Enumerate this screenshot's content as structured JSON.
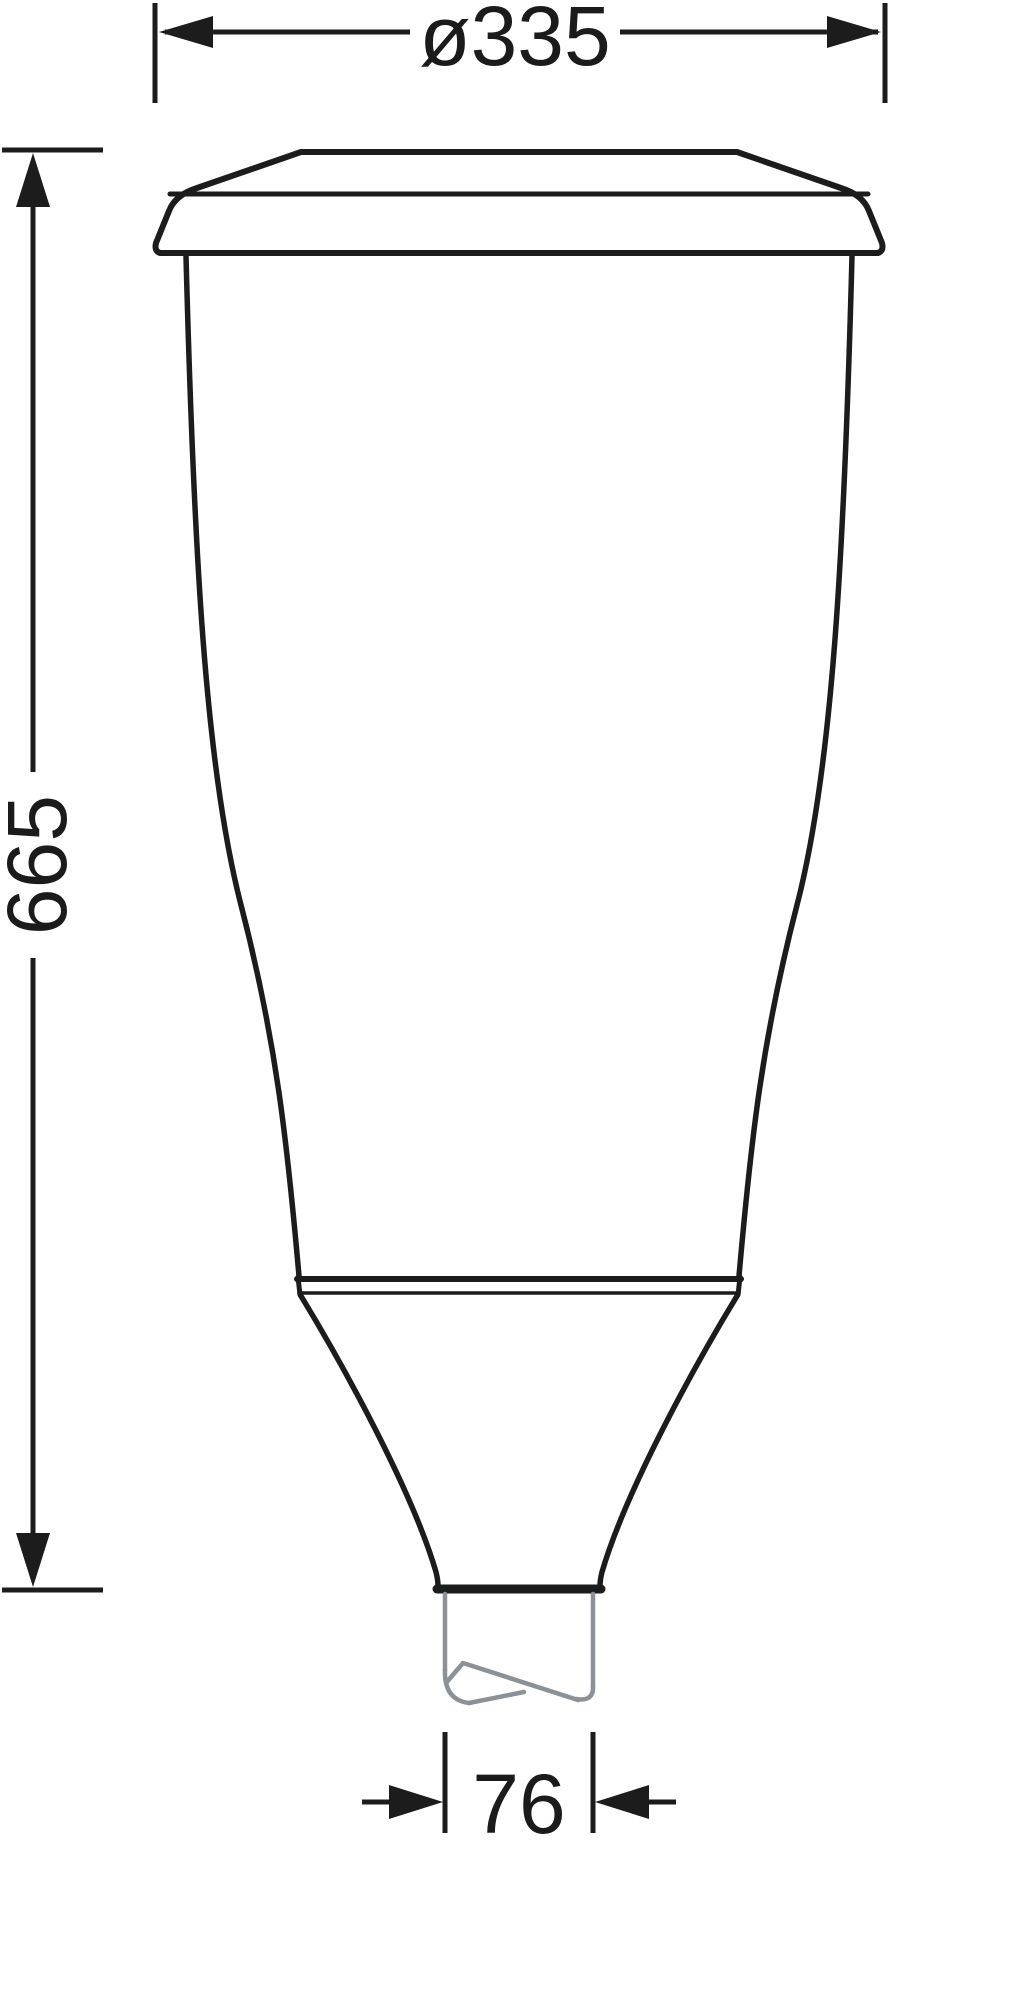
{
  "drawing": {
    "type": "technical-dimension-drawing",
    "object": "post-top-luminaire-profile",
    "dimensions": {
      "top_diameter": {
        "label": "ø335"
      },
      "overall_height": {
        "label": "665"
      },
      "spigot_diameter": {
        "label": "76"
      }
    },
    "colors": {
      "outline": "#1c1c1c",
      "spigot_gray": "#8a9197",
      "background": "#ffffff"
    }
  }
}
